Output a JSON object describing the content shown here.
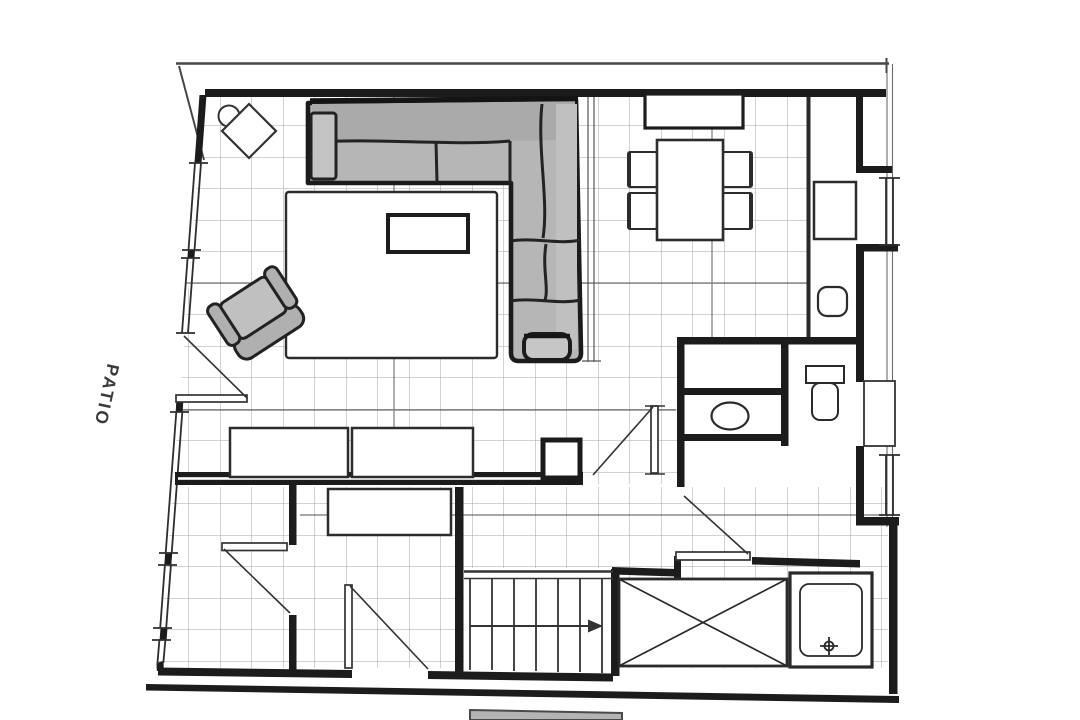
{
  "labels": {
    "patio": "PATIO"
  },
  "palette": {
    "paper": "#ffffff",
    "wall_ink": "#1c1c1c",
    "line_ink": "#333333",
    "thin_line": "#555555",
    "grid_line": "#5a5a5a",
    "pencil_shade": "#b6b6b6",
    "pencil_light": "#c4c4c4",
    "pencil_dark": "#a9a9a9",
    "doormat_gray": "#b4b4b4",
    "label_text": "#3a3a3a"
  },
  "features": {
    "left_label": "patio",
    "fixtures": [
      "sectional-sofa",
      "area-rug",
      "coffee-table",
      "armchair",
      "corner-table",
      "dining-table",
      "dining-chairs",
      "sideboard",
      "wall-cabinet",
      "stool",
      "console-units",
      "bed",
      "washbasin",
      "toilet",
      "shower-tray",
      "stairs",
      "crossed-shaft",
      "doormat"
    ]
  }
}
